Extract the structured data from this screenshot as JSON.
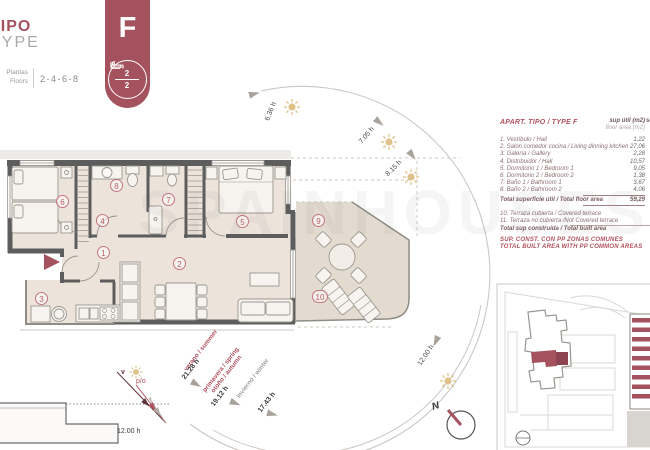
{
  "header": {
    "tipo": "TIPO",
    "type": "TYPE",
    "plantas": "Plantas",
    "floors": "Floors",
    "range": "2-4-6-8"
  },
  "banner": {
    "letter": "F",
    "beds": "2",
    "baths": "2"
  },
  "plan": {
    "rooms": [
      "1",
      "2",
      "3",
      "4",
      "5",
      "6",
      "7",
      "8",
      "9",
      "10"
    ]
  },
  "sun_path": {
    "hours": [
      "6.36 h",
      "7.05 h",
      "8.15 h",
      "12.00 h"
    ],
    "seasons": {
      "summer_label": "verano / summer",
      "summer_hours": "21.28 h",
      "spring_autumn_label_1": "primavera / spring",
      "spring_autumn_label_2": "otoño / autumn",
      "spring_autumn_hours": "19.12 h",
      "winter_label": "invierno / winter",
      "winter_hours": "17.43 h"
    },
    "section_hours": "12.00 h",
    "ray_labels": {
      "summer": "v",
      "spring_autumn": "p/o",
      "winter": "i"
    },
    "north": "N"
  },
  "table": {
    "title": "APART. TIPO / TYPE F",
    "col1_line1": "sup útil (m2)",
    "col1_line2": "floor area (m2)",
    "col2_clipped": "sup",
    "rows": [
      {
        "name": "1. Vestíbulo / Hall",
        "value": "1,22"
      },
      {
        "name": "2. Salón comedor cocina / Living dinning kitchen",
        "value": "27,06"
      },
      {
        "name": "3. Galería / Gallery",
        "value": "2,28"
      },
      {
        "name": "4. Distribuidor / Hall",
        "value": "10,57"
      },
      {
        "name": "5. Dormitorio 1 / Bedroom 1",
        "value": "9,05"
      },
      {
        "name": "6. Dormitorio 2 / Bedroom 2",
        "value": "1,38"
      },
      {
        "name": "7. Baño 1 / Bathroom 1",
        "value": "3,67"
      },
      {
        "name": "8. Baño 2 / Bathroom 2",
        "value": "4,06"
      }
    ],
    "total_floor": {
      "name": "Total superficie útil / Total floor area",
      "value": "59,29"
    },
    "extra_rows": [
      {
        "name": "10. Terraza cubierta / Covered terrace",
        "value": ""
      },
      {
        "name": "11. Terraza no cubierta /Not Covered terrace",
        "value": ""
      }
    ],
    "total_built": {
      "name": "Total sup construida / Total built area",
      "value": ""
    },
    "footer_line1": "SUP. CONST. CON PP ZONAS COMUNES",
    "footer_line2": "TOTAL BUILT AREA WITH PP COMMON AREAS"
  },
  "watermark": "SPAINHOUSES",
  "colors": {
    "accent": "#a4525e",
    "table_red": "#b2525e",
    "sun": "#dfc28a"
  }
}
